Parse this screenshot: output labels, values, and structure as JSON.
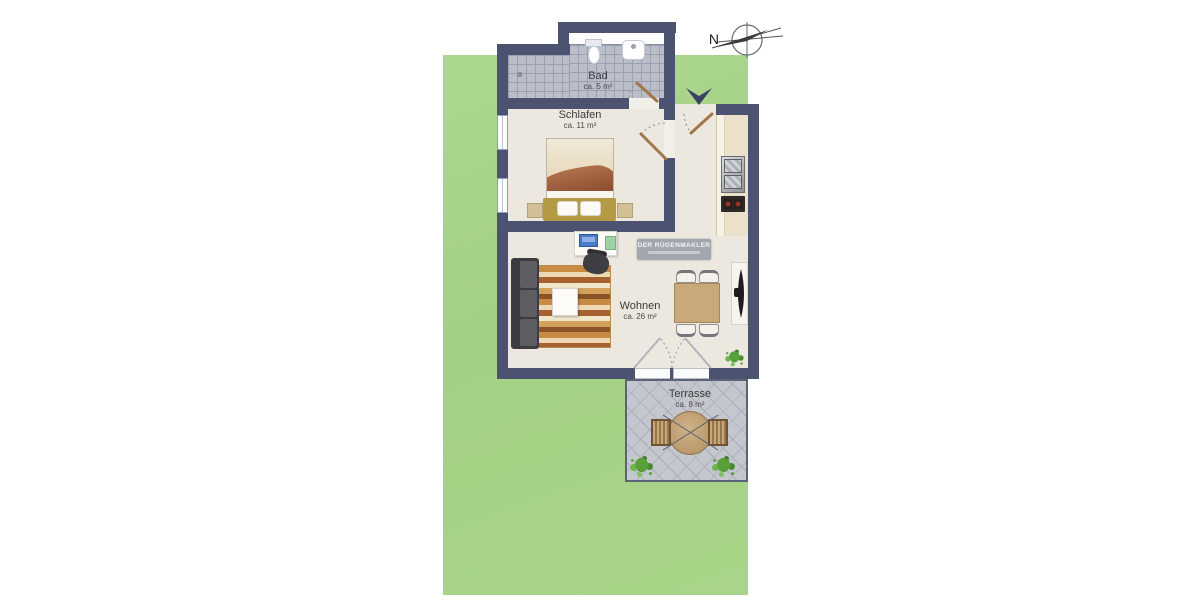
{
  "compass": {
    "label": "N"
  },
  "watermark": {
    "title": "DER RÜGENMAKLER"
  },
  "rooms": {
    "bad": {
      "name": "Bad",
      "area": "ca. 5 m²"
    },
    "schlafen": {
      "name": "Schlafen",
      "area": "ca. 11 m²"
    },
    "wohnen": {
      "name": "Wohnen",
      "area": "ca. 26 m²"
    },
    "terrasse": {
      "name": "Terrasse",
      "area": "ca. 8 m²"
    }
  },
  "colors": {
    "wall": "#4b5371",
    "lawn": "#a6d288",
    "floor": "#ece8df",
    "bath_tile": "#b9bec9",
    "terrace_paver": "#c4c7cd",
    "door_wood": "#a0774a",
    "entrance_marker": "#3a4260"
  },
  "icons": {
    "compass": "compass-rose-icon",
    "entrance": "entrance-arrow-icon"
  },
  "furniture": {
    "schlafen": [
      "double-bed",
      "pillows",
      "nightstands"
    ],
    "bad": [
      "toilet",
      "wash-basin",
      "floor-drain",
      "window-sill"
    ],
    "kueche": [
      "kitchen-counter",
      "kitchen-sink",
      "stove"
    ],
    "wohnen": [
      "sofa",
      "striped-rug",
      "coffee-table",
      "desk",
      "laptop",
      "desk-pad",
      "desk-chair",
      "dining-table",
      "dining-chairs",
      "sideboard",
      "wall-tv",
      "plant"
    ],
    "terrasse": [
      "garden-table",
      "garden-chairs",
      "shrubs"
    ]
  }
}
